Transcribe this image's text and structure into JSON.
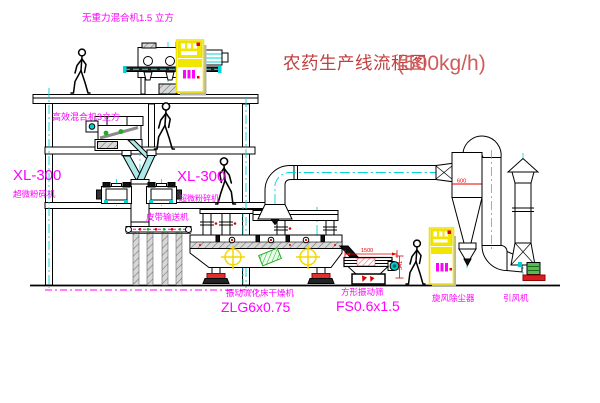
{
  "title": {
    "text": "农药生产线流程图",
    "capacity": "(500kg/h)"
  },
  "labels": {
    "mixer_top": "无重力混合机1.5 立方",
    "mixer_mid": "高效混合机3立方",
    "pulverizer_left_model": "XL-300",
    "pulverizer_left_name": "超微粉碎机",
    "pulverizer_mid_model": "XL-300",
    "pulverizer_mid_name": "超微粉碎机",
    "belt_conveyor": "皮带输送机",
    "dryer_name": "振动流化床干燥机",
    "dryer_model": "ZLG6x0.75",
    "sieve_name": "方形振动筛",
    "sieve_model": "FS0.6x1.5",
    "cyclone_name": "旋风除尘器",
    "fan_name": "引风机",
    "dim_sieve_width": "1500",
    "dim_sieve_height": "541",
    "dim_cyclone": "600"
  },
  "colors": {
    "label_magenta": "#ff00ff",
    "title_red": "#c04040",
    "centerline_cyan": "#00d5d5",
    "cabinet_yellow": "#f2e500",
    "status_red": "#e00000",
    "detail_green": "#22aa22",
    "line_black": "#000000"
  }
}
